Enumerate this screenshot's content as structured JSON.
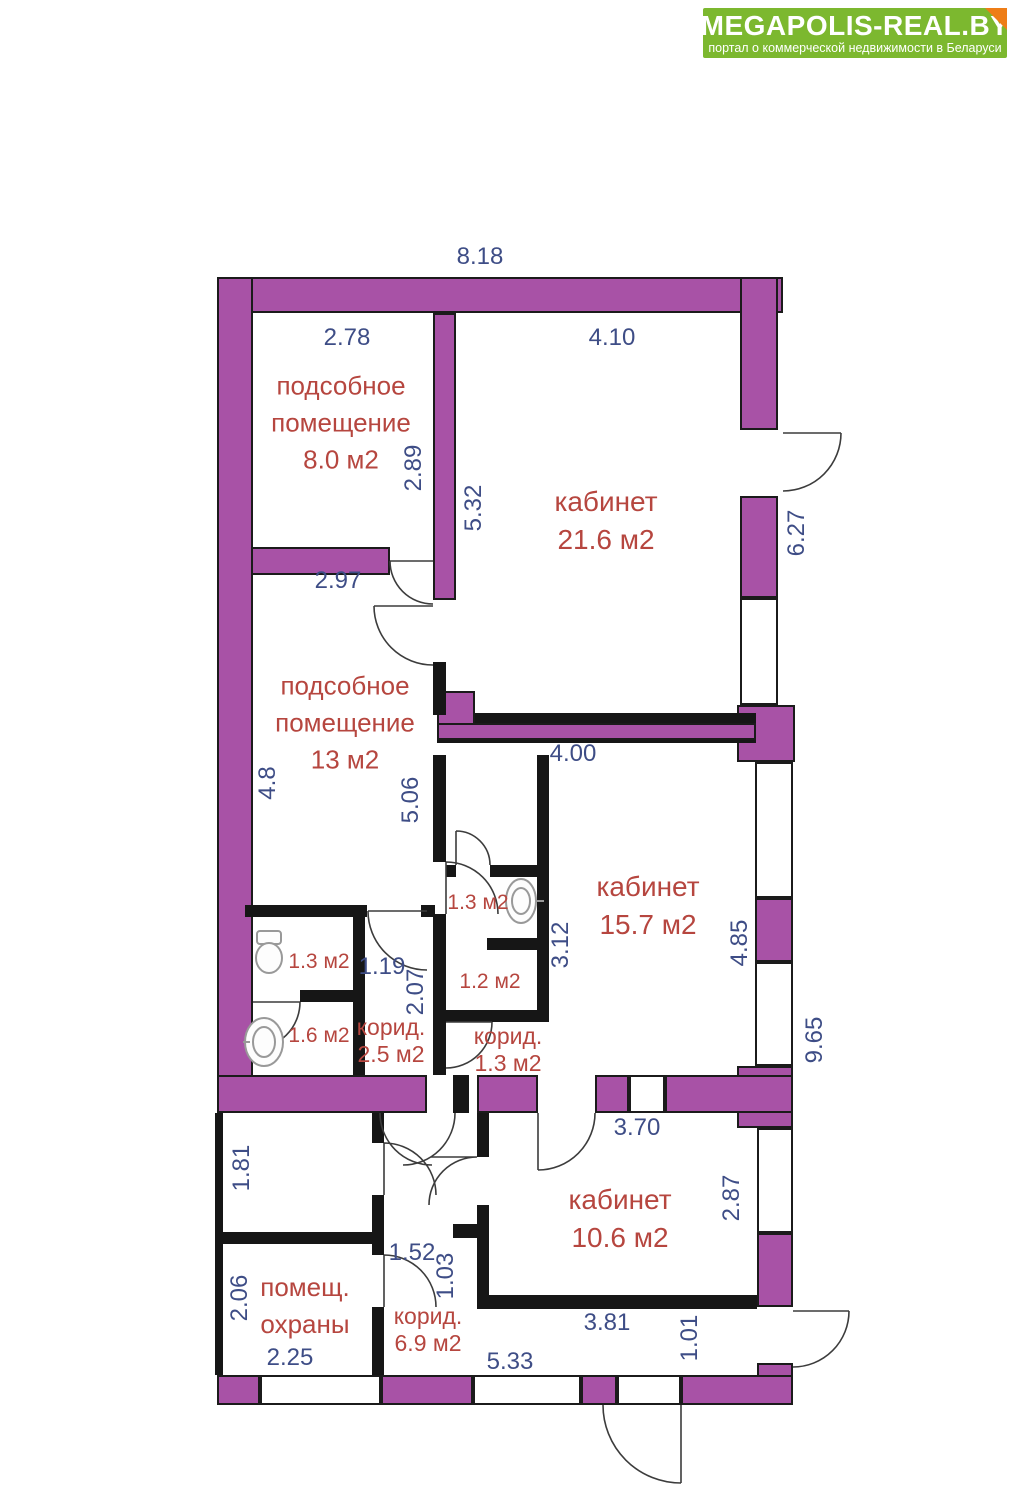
{
  "header": {
    "title": "MEGAPOLIS-REAL.BY",
    "subtitle": "портал о коммерческой недвижимости в Беларуси"
  },
  "colors": {
    "brand_green": "#7cb82f",
    "fold_orange": "#ee7d17",
    "wall_purple": "#a852a6",
    "wall_black": "#161616",
    "dim_blue": "#3e4d86",
    "room_red": "#b6463f"
  },
  "floorplan": {
    "rooms": {
      "utility8": {
        "name": "подсобное помещение",
        "area": "8.0 м2"
      },
      "office216": {
        "name": "кабинет",
        "area": "21.6 м2"
      },
      "utility13": {
        "name": "подсобное помещение",
        "area": "13 м2"
      },
      "office157": {
        "name": "кабинет",
        "area": "15.7 м2"
      },
      "office106": {
        "name": "кабинет",
        "area": "10.6 м2"
      },
      "guard": {
        "name": "помещ. охраны"
      },
      "corridor25": {
        "name": "корид.",
        "area": "2.5 м2"
      },
      "corridor13": {
        "name": "корид.",
        "area": "1.3 м2"
      },
      "corridor69": {
        "name": "корид.",
        "area": "6.9 м2"
      },
      "san13a": {
        "area": "1.3 м2"
      },
      "san12": {
        "area": "1.2 м2"
      },
      "san13b": {
        "area": "1.3 м2"
      },
      "san16": {
        "area": "1.6 м2"
      }
    },
    "dimensions": {
      "d818": "8.18",
      "d278": "2.78",
      "d410": "4.10",
      "d289": "2.89",
      "d532": "5.32",
      "d627": "6.27",
      "d297": "2.97",
      "d400": "4.00",
      "d48": "4.8",
      "d506": "5.06",
      "d119": "1.19",
      "d207": "2.07",
      "d312": "3.12",
      "d485": "4.85",
      "d965": "9.65",
      "d181": "1.81",
      "d370": "3.70",
      "d287": "2.87",
      "d152": "1.52",
      "d103": "1.03",
      "d206": "2.06",
      "d225": "2.25",
      "d381": "3.81",
      "d101": "1.01",
      "d533": "5.33"
    }
  }
}
